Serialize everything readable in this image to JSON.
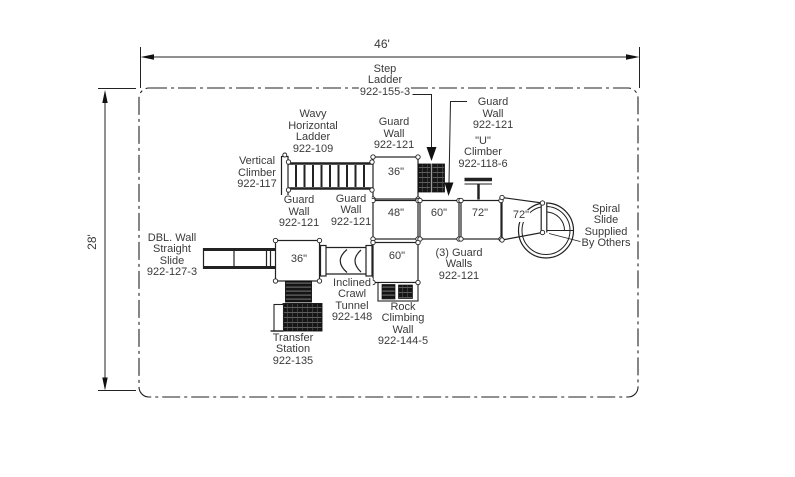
{
  "drawing_title": "playground-structure-plan",
  "colors": {
    "line": "#222222",
    "text": "#3a3a3a",
    "dark_fill": "#161616",
    "background": "#ffffff"
  },
  "dimensions": {
    "width": "46'",
    "height": "28'"
  },
  "labels": {
    "step_ladder": "Step\nLadder\n922-155-3",
    "guard_wall_top_right": "Guard\nWall\n922-121",
    "wavy_horizontal_ladder": "Wavy\nHorizontal\nLadder\n922-109",
    "guard_wall_top": "Guard\nWall\n922-121",
    "u_climber": "\"U\"\nClimber\n922-118-6",
    "vertical_climber": "Vertical\nClimber\n922-117",
    "guard_wall_left": "Guard\nWall\n922-121",
    "guard_wall_mid": "Guard\nWall\n922-121",
    "dbl_wall_straight_slide": "DBL. Wall\nStraight\nSlide\n922-127-3",
    "spiral_slide": "Spiral\nSlide\nSupplied\nBy Others",
    "three_guard_walls": "(3) Guard\nWalls\n922-121",
    "inclined_crawl_tunnel": "Inclined\nCrawl\nTunnel\n922-148",
    "rock_climbing_wall": "Rock\nClimbing\nWall\n922-144-5",
    "transfer_station": "Transfer\nStation\n922-135"
  },
  "decks": {
    "deck_36_top": "36\"",
    "deck_48": "48\"",
    "deck_60_mid": "60\"",
    "deck_72_a": "72\"",
    "deck_72_b": "72\"",
    "deck_36_low": "36\"",
    "deck_60_low": "60\""
  }
}
